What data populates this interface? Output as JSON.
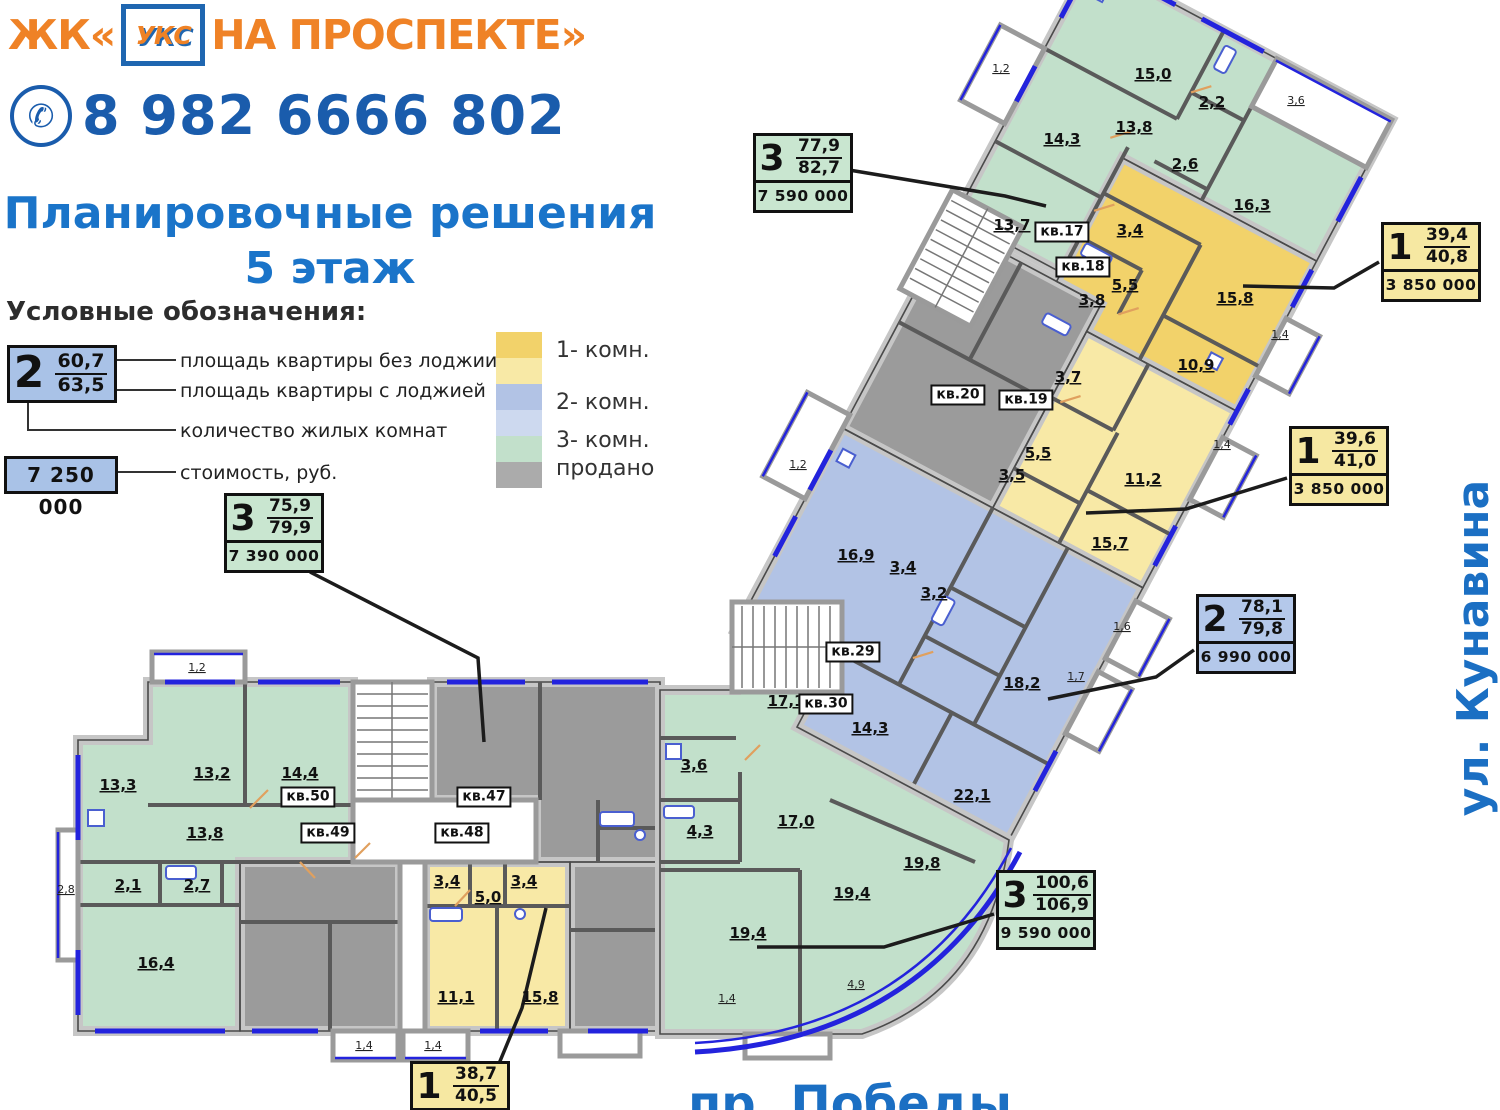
{
  "colors": {
    "room1_dark": "#f2d26a",
    "room1_light": "#f8e9a6",
    "room2_dark": "#b2c3e5",
    "room2_light": "#cdd9ef",
    "room3": "#c2e0cb",
    "sold": "#9b9b9b",
    "white": "#ffffff"
  },
  "card_colors": {
    "green": "#c9e6d0",
    "yellow": "#f6e8a2",
    "blue": "#b4c8ea",
    "sample": "#a9c2e7"
  },
  "header": {
    "logo_prefix": "ЖК«",
    "logo_mark": "УКС",
    "logo_suffix": "НА ПРОСПЕКТЕ»",
    "phone_icon": "✆",
    "phone": "8 982 6666 802",
    "title_line1": "Планировочные решения",
    "title_line2": "5 этаж"
  },
  "legend": {
    "heading": "Условные обозначения:",
    "sample_rooms": "2",
    "sample_area_top": "60,7",
    "sample_area_bottom": "63,5",
    "sample_price": "7 250 000",
    "label_area_top": "площадь квартиры без лоджии",
    "label_area_bottom": "площадь квартиры с лоджией",
    "label_rooms": "количество жилых комнат",
    "label_price": "стоимость, руб.",
    "types": [
      {
        "label": "1- комн."
      },
      {
        "label": "2- комн."
      },
      {
        "label": "3- комн."
      },
      {
        "label": "продано"
      }
    ],
    "swatches": [
      "#f2d26a",
      "#f8e9a6",
      "#b2c3e5",
      "#cdd9ef",
      "#c2e0cb",
      "#ababab"
    ]
  },
  "streets": {
    "right": "ул. Кунавина",
    "bottom": "пр. Победы"
  },
  "cards": [
    {
      "rooms": "3",
      "area_top": "77,9",
      "area_bottom": "82,7",
      "price": "7 590 000"
    },
    {
      "rooms": "1",
      "area_top": "39,4",
      "area_bottom": "40,8",
      "price": "3 850 000"
    },
    {
      "rooms": "1",
      "area_top": "39,6",
      "area_bottom": "41,0",
      "price": "3 850 000"
    },
    {
      "rooms": "2",
      "area_top": "78,1",
      "area_bottom": "79,8",
      "price": "6 990 000"
    },
    {
      "rooms": "3",
      "area_top": "75,9",
      "area_bottom": "79,9",
      "price": "7 390 000"
    },
    {
      "rooms": "3",
      "area_top": "100,6",
      "area_bottom": "106,9",
      "price": "9 590 000"
    },
    {
      "rooms": "1",
      "area_top": "38,7",
      "area_bottom": "40,5"
    }
  ],
  "plan": {
    "units": {
      "u17": "кв.17",
      "u18": "кв.18",
      "u19": "кв.19",
      "u20": "кв.20",
      "u29": "кв.29",
      "u30": "кв.30",
      "u47": "кв.47",
      "u48": "кв.48",
      "u49": "кв.49",
      "u50": "кв.50"
    },
    "rooms": {
      "r1": "1,2",
      "r2": "13,2",
      "r3": "14,4",
      "r4": "13,3",
      "r5": "13,8",
      "r6": "2,8",
      "r7": "2,1",
      "r8": "2,7",
      "r9": "16,4",
      "r10": "1,4",
      "r11": "1,4",
      "r12": "3,4",
      "r13": "3,4",
      "r14": "5,0",
      "r15": "11,1",
      "r16": "15,8",
      "r17": "17,1",
      "r18": "3,6",
      "r19": "4,3",
      "r20": "17,0",
      "r21": "19,8",
      "r22": "19,4",
      "r23": "19,4",
      "r24": "4,9",
      "r25": "1,4",
      "r26": "16,9",
      "r27": "3,4",
      "r28": "3,2",
      "r29": "18,2",
      "r30": "14,3",
      "r31": "22,1",
      "r32": "1,6",
      "r33": "1,7",
      "r34": "1,2",
      "r35": "15,7",
      "r36": "3,5",
      "r37": "5,5",
      "r38": "11,2",
      "r39": "3,7",
      "r40": "1,4",
      "r41": "10,9",
      "r42": "3,8",
      "r43": "5,5",
      "r44": "15,8",
      "r45": "3,4",
      "r46": "1,4",
      "r47": "13,7",
      "r48": "14,3",
      "r49": "13,8",
      "r50": "2,6",
      "r51": "16,3",
      "r52": "15,0",
      "r53": "2,2",
      "r54": "3,6",
      "r55": "1,2"
    }
  }
}
